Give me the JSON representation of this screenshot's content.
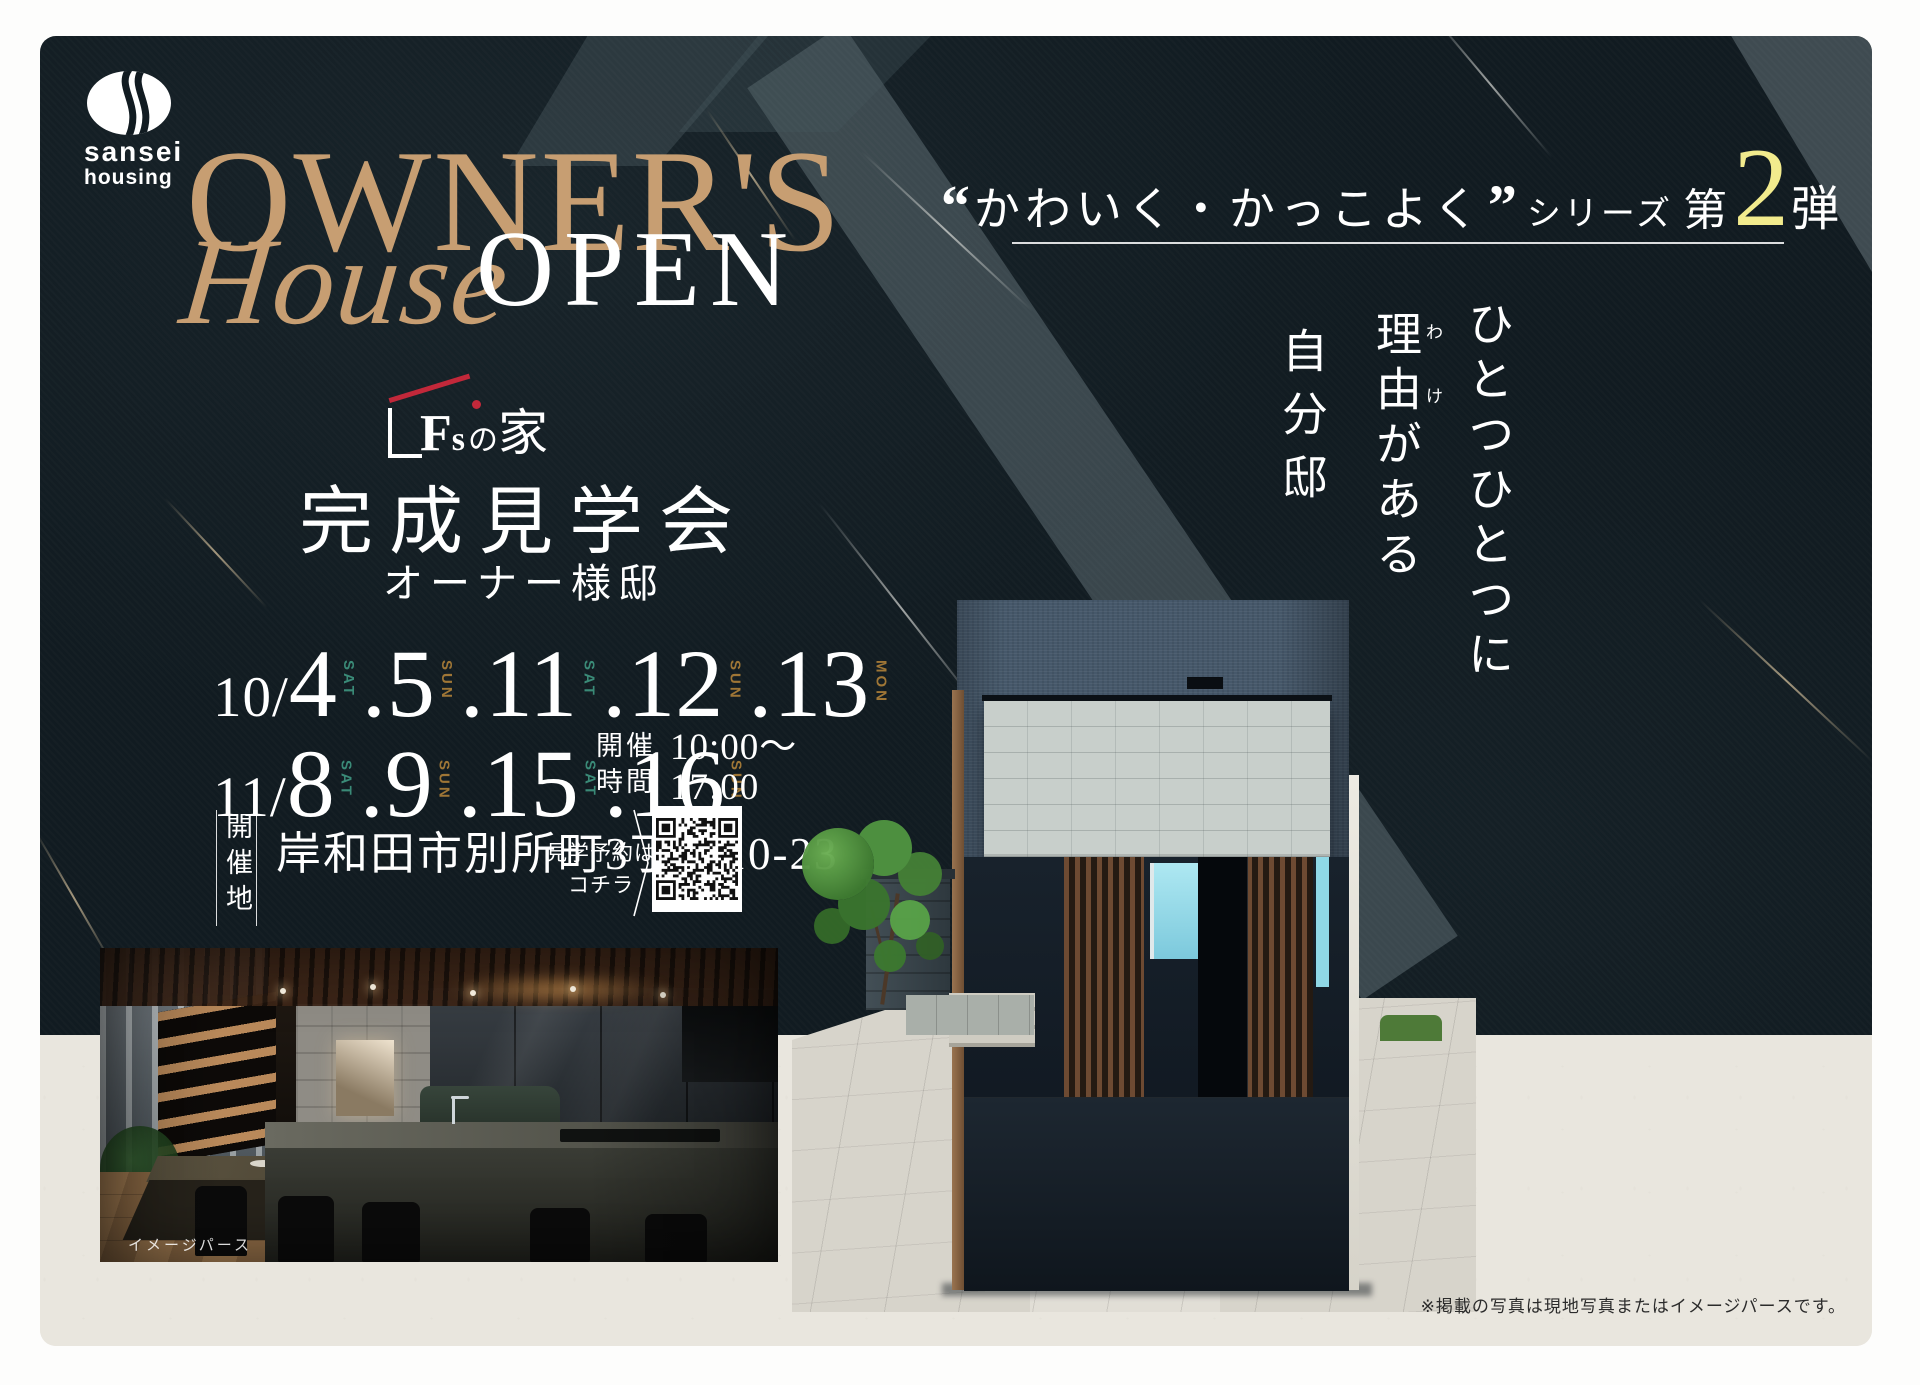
{
  "brand": {
    "mark": "sansei-housing-mark",
    "line1": "sansei",
    "line2": "housing"
  },
  "hero": {
    "owners": "OWNER'S",
    "house": "House",
    "open": "OPEN",
    "accent_color": "#c79e72"
  },
  "fs_logo": {
    "f": "F",
    "s": "s",
    "no": "の",
    "ie": "家",
    "roof_color": "#c2283a"
  },
  "event": {
    "title": "完成見学会",
    "subtitle": "オーナー様邸"
  },
  "series": {
    "quote_open": "“",
    "text": "かわいく・かっこよく",
    "quote_close": "”",
    "series_word": "シリーズ",
    "dai": "第",
    "number": "2",
    "dan": "弾",
    "number_color": "#f2eb8d"
  },
  "copy_vertical": {
    "line1": "ひとつひとつに",
    "line2": "理由がある",
    "line2_furigana_1": "わ",
    "line2_furigana_2": "け",
    "line3": "自分邸"
  },
  "schedule": {
    "rows": [
      {
        "month": "10/",
        "dates": [
          {
            "prefix": "",
            "day": "4",
            "dow": "SAT"
          },
          {
            "prefix": ".",
            "day": "5",
            "dow": "SUN"
          },
          {
            "prefix": ".",
            "day": "11",
            "dow": "SAT"
          },
          {
            "prefix": ".",
            "day": "12",
            "dow": "SUN"
          },
          {
            "prefix": ".",
            "day": "13",
            "dow": "MON"
          }
        ]
      },
      {
        "month": "11/",
        "dates": [
          {
            "prefix": "",
            "day": "8",
            "dow": "SAT"
          },
          {
            "prefix": ".",
            "day": "9",
            "dow": "SUN"
          },
          {
            "prefix": ".",
            "day": "15",
            "dow": "SAT"
          },
          {
            "prefix": ".",
            "day": "16",
            "dow": "SUN"
          }
        ]
      }
    ],
    "dow_colors": {
      "SAT": "#3a8a77",
      "SUN": "#9f7636",
      "MON": "#9f7636"
    }
  },
  "time": {
    "label_line1": "開催",
    "label_line2": "時間",
    "start": "10:00～",
    "end": "17:00"
  },
  "venue": {
    "label": "開催地",
    "address": "岸和田市別所町3丁目10-23",
    "reserve_line1": "見学予約は",
    "reserve_line2": "コチラ",
    "qr": "qr-code"
  },
  "captions": {
    "interior": "イメージパース",
    "disclaimer": "※掲載の写真は現地写真またはイメージパースです。"
  },
  "palette": {
    "panel_dark": "#111b21",
    "paper": "#e9e6de",
    "title_gold": "#c79e72",
    "sat": "#3a8a77",
    "sun": "#9f7636",
    "mon": "#9f7636",
    "number_yellow": "#f2eb8d"
  }
}
